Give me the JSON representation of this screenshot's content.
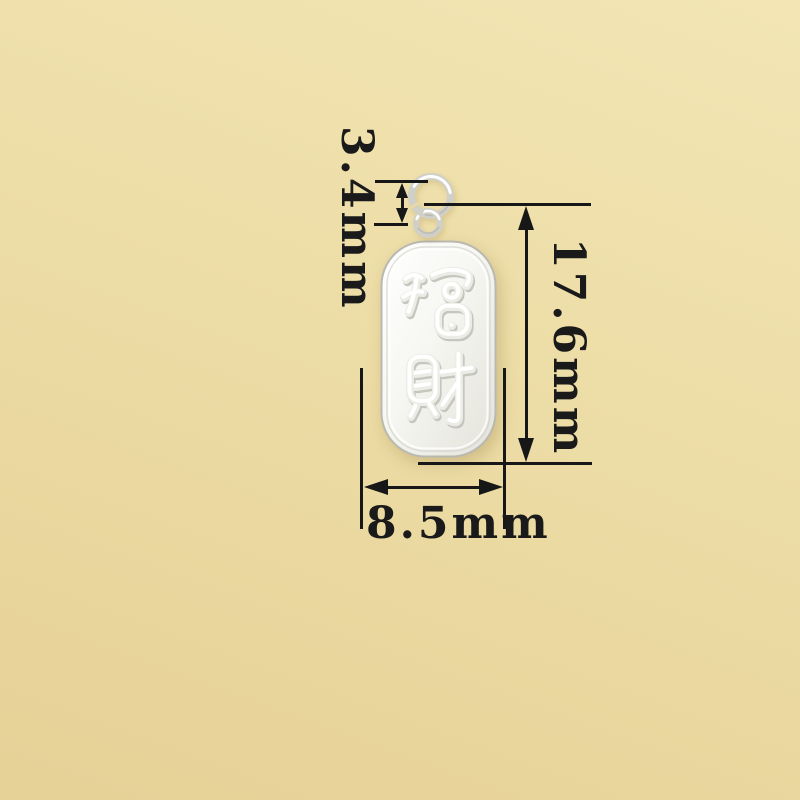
{
  "photo": {
    "pendant": {
      "engraving": "招财",
      "engraving_top_char": "招",
      "engraving_bottom_char": "财",
      "metal_color": "#f6f6f2",
      "metal_edge_color": "#b9b9b1"
    },
    "dimensions": {
      "ring_height": "3.4mm",
      "tag_height": "17.6mm",
      "tag_width": "8.5mm",
      "ink_color": "#171717"
    },
    "background": {
      "light_color": "#f3e6b5",
      "dark_color": "#e6d196"
    }
  }
}
